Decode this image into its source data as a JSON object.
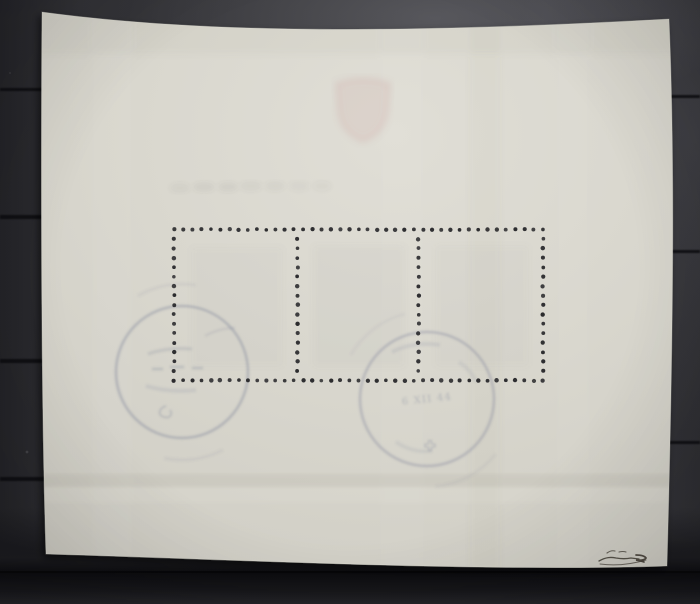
{
  "scene": {
    "type": "photograph",
    "subject": "Back side of a cancelled souvenir stamp sheet of three stamps mounted on a dark stockbook page"
  },
  "stockbook": {
    "base_color": "#3a3a3e",
    "ridge_color": "#0b0b0e",
    "bottom_band_color": "#121215"
  },
  "sheet": {
    "paper_color": "#d7d5cc",
    "paper_highlight": "#e0ded6",
    "perforation": {
      "panes": 3,
      "holes_top_row": 41,
      "holes_per_column": 17,
      "hole_color": "#27272a"
    }
  },
  "postmarks": {
    "ink_color": "#6b7390",
    "count": 2,
    "left": {
      "shape": "circular-cds"
    },
    "center": {
      "shape": "circular-cds",
      "date_text": "6 XII 44",
      "has_swiss_cross_mark": true
    }
  },
  "showthrough": {
    "coat_of_arms_color": "#c2837d",
    "position": "top-center"
  },
  "signature": {
    "kind": "expert-mark-handwritten",
    "ink_color": "#413c33"
  }
}
